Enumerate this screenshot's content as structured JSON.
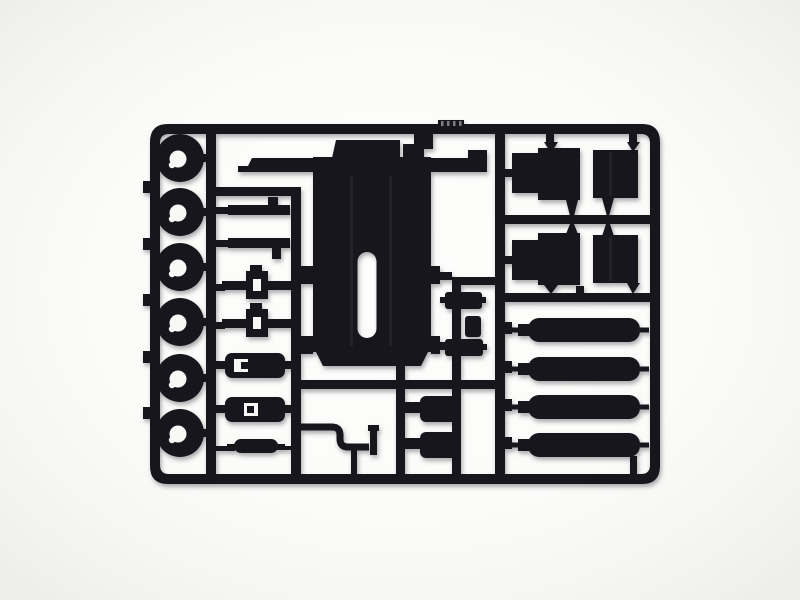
{
  "image": {
    "kind": "product photograph",
    "subject": "injection-molded model kit sprue of black styrene parts on a plain white studio background",
    "background_style": "plain light studio background, soft shadow under the parts tree"
  },
  "colors": {
    "plastic": "#13131a",
    "plastic_seam": "#20202a",
    "molded_mark": "#7c7c84",
    "background_center": "#fdfdfc",
    "background_edge": "#ededeb",
    "hole_cutout": "#f8f8f6",
    "shadow": "#595c64"
  },
  "sprue": {
    "frame": "rectangular runner frame with rounded corners and internal runner bars",
    "parts": [
      {
        "name": "road-wheel",
        "count": 6,
        "location": "left column"
      },
      {
        "name": "leaf-spring",
        "count": 2,
        "location": "upper middle column"
      },
      {
        "name": "axle-with-hub",
        "count": 2,
        "location": "middle column"
      },
      {
        "name": "stowage-box",
        "count": 2,
        "location": "lower middle column"
      },
      {
        "name": "small-cylinder",
        "count": 1,
        "location": "bottom middle column"
      },
      {
        "name": "deck-panel",
        "count": 1,
        "location": "center, large slab with oval slot"
      },
      {
        "name": "seat-back",
        "count": 4,
        "location": "upper right, two-by-two grid"
      },
      {
        "name": "air-tank",
        "count": 4,
        "location": "lower right, stacked horizontal cylinders"
      },
      {
        "name": "bent-pipe",
        "count": 1,
        "location": "bottom center"
      },
      {
        "name": "bracket-block",
        "count": 3,
        "location": "center right runner"
      },
      {
        "name": "equipment-box",
        "count": 2,
        "location": "bottom center-right"
      }
    ]
  }
}
